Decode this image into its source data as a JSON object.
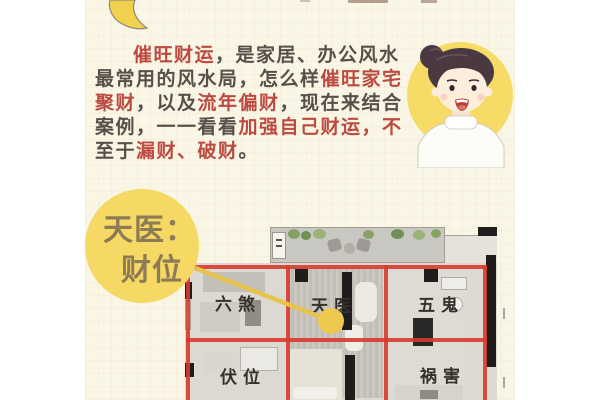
{
  "intro": {
    "lines": [
      [
        {
          "t": "催旺财运",
          "c": "red"
        },
        {
          "t": "，是家居、办公风水",
          "c": "dark"
        }
      ],
      [
        {
          "t": "最常用的风水局，怎么样",
          "c": "dark"
        },
        {
          "t": "催旺家宅",
          "c": "red"
        }
      ],
      [
        {
          "t": "聚财",
          "c": "red"
        },
        {
          "t": "，以及",
          "c": "dark"
        },
        {
          "t": "流年偏财",
          "c": "red"
        },
        {
          "t": "，现在来结合",
          "c": "dark"
        }
      ],
      [
        {
          "t": "案例，一一看看",
          "c": "dark"
        },
        {
          "t": "加强自己财运，不",
          "c": "red"
        }
      ],
      [
        {
          "t": "至于",
          "c": "dark"
        },
        {
          "t": "漏财、破财",
          "c": "red"
        },
        {
          "t": "。",
          "c": "dark"
        }
      ]
    ]
  },
  "callout": {
    "line1": "天医：",
    "line2": "财位"
  },
  "plan": {
    "cells": [
      {
        "label": "六煞"
      },
      {
        "label": "天医"
      },
      {
        "label": "五鬼"
      },
      {
        "label": "伏位"
      },
      {
        "label": "祸害"
      }
    ]
  },
  "icons": {
    "moon": "crescent-moon",
    "avatar": "woman-face",
    "marker": "wealth-spot-dot"
  },
  "colors": {
    "page_margin": "#ffffff",
    "content_bg": "#faf6e5",
    "accent_red_text": "#bc4a40",
    "body_dark_text": "#57504a",
    "highlight_yellow": "#f5d964",
    "callout_text_brown": "#8d7b55",
    "grid_red": "#d83a2e",
    "marker_gold": "#eec94f",
    "plan_base_gray": "#dcd8d2"
  }
}
